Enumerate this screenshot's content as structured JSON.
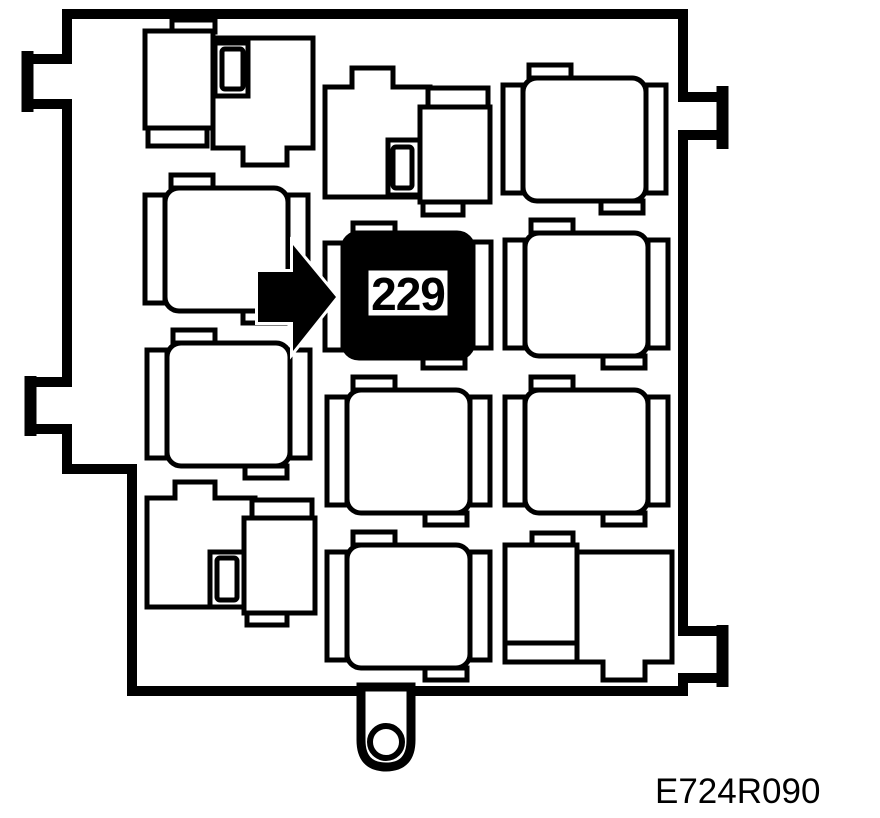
{
  "labels": {
    "highlighted_relay": "229",
    "figure_reference": "E724R090"
  },
  "colors": {
    "line": "#000000",
    "background": "#ffffff",
    "highlight_fill": "#000000",
    "label_background": "#ffffff"
  }
}
